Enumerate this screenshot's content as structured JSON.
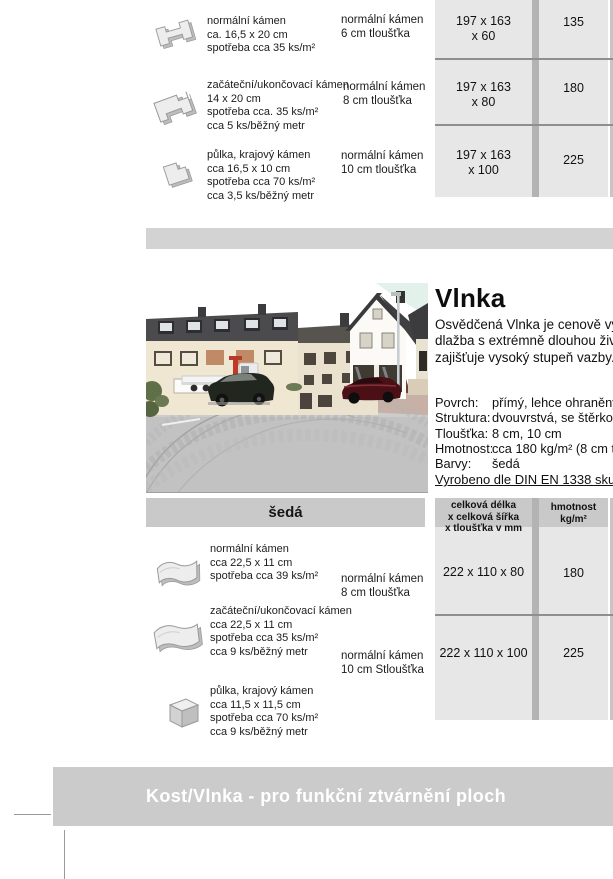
{
  "top_table": {
    "rows": [
      {
        "description": [
          "normální kámen",
          "ca. 16,5 x 20 cm",
          "spotřeba cca 35 ks/m²"
        ],
        "variant": [
          "normální kámen",
          "6 cm tloušťka"
        ],
        "dimensions": [
          "197 x 163",
          "x 60"
        ],
        "weight": "135"
      },
      {
        "description": [
          "začáteční/ukončovací kámen",
          "14 x 20 cm",
          "spotřeba cca. 35 ks/m²",
          "cca 5 ks/běžný metr"
        ],
        "variant": [
          "normální kámen",
          "8 cm tloušťka"
        ],
        "dimensions": [
          "197 x 163",
          "x 80"
        ],
        "weight": "180"
      },
      {
        "description": [
          "půlka, krajový kámen",
          "cca 16,5 x 10 cm",
          "spotřeba cca 70 ks/m²",
          "cca 3,5 ks/běžný metr"
        ],
        "variant": [
          "normální kámen",
          "10 cm tloušťka"
        ],
        "dimensions": [
          "197 x 163",
          "x 100"
        ],
        "weight": "225"
      }
    ]
  },
  "product": {
    "title": "Vlnka",
    "intro": [
      "Osvědčená Vlnka je cenově výho",
      "dlažba s extrémně dlouhou živo",
      "zajišťuje vysoký stupeň vazby."
    ],
    "specs": [
      {
        "label": "Povrch:",
        "value": "přímý, lehce ohraněný"
      },
      {
        "label": "Struktura:",
        "value": "dvouvrstvá, se štěrkovou"
      },
      {
        "label": "Tloušťka:",
        "value": "8 cm, 10 cm"
      },
      {
        "label": "Hmotnost:",
        "value": "cca 180 kg/m² (8 cm tlou"
      },
      {
        "label": "Barvy:",
        "value": "šedá"
      }
    ],
    "standard_note": "Vyrobeno dle DIN EN 1338 skupiny"
  },
  "color_band": {
    "label": "šedá"
  },
  "bottom_table": {
    "header": {
      "dimensions": [
        "celková délka",
        "x celková šířka",
        "x tloušťka v mm"
      ],
      "weight": [
        "hmotnost",
        "kg/m²"
      ]
    },
    "rows": [
      {
        "dimensions": "222 x 110 x 80",
        "weight": "180"
      },
      {
        "dimensions": "222 x 110 x 100",
        "weight": "225"
      }
    ],
    "left_rows": [
      {
        "description": [
          "normální kámen",
          "cca 22,5 x 11 cm",
          "spotřeba cca 39 ks/m²"
        ],
        "variant": [
          "normální kámen",
          "8 cm tloušťka"
        ]
      },
      {
        "description": [
          "začáteční/ukončovací kámen",
          "cca 22,5 x 11 cm",
          "spotřeba cca 35 ks/m²",
          "cca 9 ks/běžný metr"
        ],
        "variant": [
          "normální kámen",
          "10 cm Stloušťka"
        ]
      },
      {
        "description": [
          "půlka, krajový kámen",
          "cca 11,5 x 11,5 cm",
          "spotřeba cca 70 ks/m²",
          "cca 9 ks/běžný metr"
        ]
      }
    ]
  },
  "footer": {
    "banner": "Kost/Vlnka - pro funkční ztvárnění ploch"
  },
  "colors": {
    "cell_bg": "#e7e7e7",
    "header_bg": "#c9c9c9",
    "column_gap": "#b3b3b3",
    "section_divider": "#d3d3d3",
    "footer_bar": "#cbcbcb",
    "separator_line": "#8f8f8f"
  }
}
